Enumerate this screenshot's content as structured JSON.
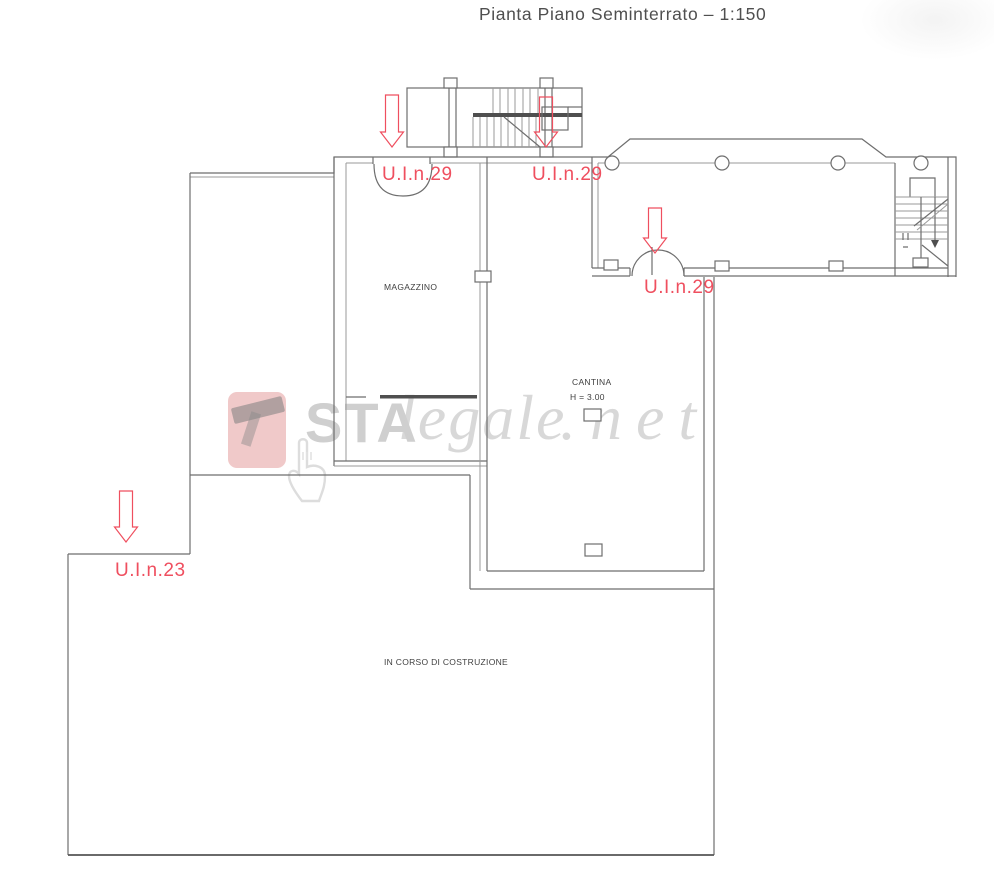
{
  "title": "Pianta Piano Seminterrato – 1:150",
  "unit_labels": {
    "top_left": "U.I.n.29",
    "top_right": "U.I.n.29",
    "wing": "U.I.n.29",
    "lower_left": "U.I.n.23"
  },
  "room_labels": {
    "magazzino": "MAGAZZINO",
    "cantina": "CANTINA",
    "cantina_height": "H = 3.00",
    "construction": "IN CORSO DI COSTRUZIONE"
  },
  "watermark": {
    "sta": "STA",
    "legale": "legale",
    "net": ".net"
  },
  "colors": {
    "line": "#6e6e6e",
    "red": "#ef4f5f",
    "watermark_gray": "#cfcfcf"
  }
}
